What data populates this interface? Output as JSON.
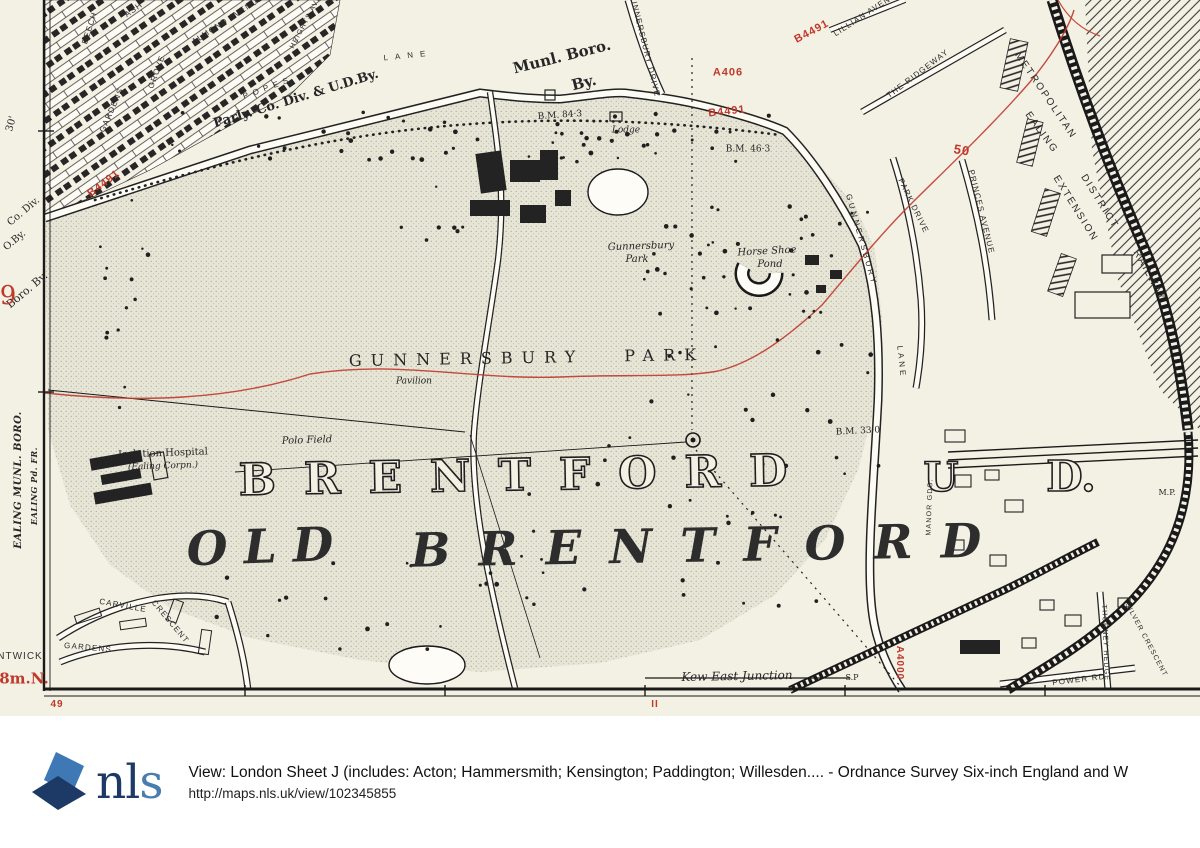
{
  "map": {
    "colors": {
      "paper": "#f3f0e4",
      "ink": "#262626",
      "red": "#c0392b",
      "road_fill": "#fcfbf4",
      "stipple_base": "#e7e5d6"
    },
    "labels": [
      {
        "n": "street-almond-avenue",
        "t": "ALMOND AVENUE",
        "x": 228,
        "y": 20,
        "s": 8,
        "r": -33,
        "c": "street"
      },
      {
        "n": "street-beech",
        "t": "BEECH",
        "x": 90,
        "y": 28,
        "s": 8,
        "r": -72,
        "c": "street"
      },
      {
        "n": "street-ash",
        "t": "ASH",
        "x": 134,
        "y": 10,
        "s": 8,
        "r": -35,
        "c": "street"
      },
      {
        "n": "street-gardens-nw",
        "t": "GARDENS",
        "x": 112,
        "y": 110,
        "s": 8,
        "r": -66,
        "c": "street"
      },
      {
        "n": "street-grove",
        "t": "GROVE",
        "x": 157,
        "y": 72,
        "s": 8,
        "r": -70,
        "c": "street"
      },
      {
        "n": "street-heights-ave",
        "t": "HEIGHTS AVE",
        "x": 306,
        "y": 22,
        "s": 7,
        "r": -62,
        "c": "street"
      },
      {
        "n": "street-popes",
        "t": "POPES",
        "x": 268,
        "y": 88,
        "s": 8,
        "r": -20,
        "c": "street",
        "ls": 5
      },
      {
        "n": "street-popes-lane",
        "t": "LANE",
        "x": 408,
        "y": 56,
        "s": 8,
        "r": -6,
        "c": "street",
        "ls": 7
      },
      {
        "n": "boundary-parly-co-div",
        "t": "Parly. Co. Div. & U.D.By.",
        "x": 296,
        "y": 99,
        "s": 13,
        "r": -17,
        "c": "serifb"
      },
      {
        "n": "boundary-munl-boro",
        "t": "Munl. Boro.",
        "x": 562,
        "y": 57,
        "s": 15,
        "r": -14,
        "c": "serifb"
      },
      {
        "n": "boundary-munl-boro-by",
        "t": "By.",
        "x": 584,
        "y": 83,
        "s": 15,
        "r": -14,
        "c": "serifb"
      },
      {
        "n": "road-number-b4491-west",
        "t": "B4491",
        "x": 104,
        "y": 184,
        "s": 11,
        "r": -37,
        "c": "red"
      },
      {
        "n": "road-number-a406",
        "t": "A406",
        "x": 728,
        "y": 73,
        "s": 11,
        "r": 0,
        "c": "red"
      },
      {
        "n": "road-number-b4491-north",
        "t": "B4491",
        "x": 727,
        "y": 112,
        "s": 11,
        "r": -6,
        "c": "red"
      },
      {
        "n": "road-number-b4491-ne",
        "t": "B4491",
        "x": 812,
        "y": 32,
        "s": 11,
        "r": -28,
        "c": "red"
      },
      {
        "n": "street-gunnersbury-drive",
        "t": "GUNNERSBURY DRIVE",
        "x": 644,
        "y": 44,
        "s": 8,
        "r": 76,
        "c": "street"
      },
      {
        "n": "street-lillian-avenue",
        "t": "LILLIAN AVENUE",
        "x": 868,
        "y": 13,
        "s": 8,
        "r": -33,
        "c": "street"
      },
      {
        "n": "street-the-ridgeway",
        "t": "THE RIDGEWAY",
        "x": 918,
        "y": 74,
        "s": 8,
        "r": -37,
        "c": "street"
      },
      {
        "n": "street-park-drive",
        "t": "PARK DRIVE",
        "x": 913,
        "y": 206,
        "s": 8,
        "r": 64,
        "c": "street"
      },
      {
        "n": "street-princes-avenue",
        "t": "PRINCES AVENUE",
        "x": 981,
        "y": 212,
        "s": 8,
        "r": 76,
        "c": "street"
      },
      {
        "n": "contour-number-50",
        "t": "50",
        "x": 962,
        "y": 150,
        "s": 13,
        "r": 10,
        "c": "red"
      },
      {
        "n": "street-gunnersbury-lane",
        "t": "GUNNERSBURY",
        "x": 861,
        "y": 240,
        "s": 8,
        "r": 74,
        "c": "street",
        "ls": 3
      },
      {
        "n": "street-gunnersbury-lane-2",
        "t": "LANE",
        "x": 901,
        "y": 362,
        "s": 8,
        "r": 84,
        "c": "street",
        "ls": 3
      },
      {
        "n": "railway-metropolitan",
        "t": "METROPOLITAN",
        "x": 1045,
        "y": 96,
        "s": 10,
        "r": 56,
        "c": "street",
        "ls": 2
      },
      {
        "n": "railway-district",
        "t": "DISTRICT",
        "x": 1099,
        "y": 202,
        "s": 10,
        "r": 58,
        "c": "street",
        "ls": 2
      },
      {
        "n": "railway-railway",
        "t": "RAILWAY",
        "x": 1149,
        "y": 276,
        "s": 10,
        "r": 61,
        "c": "street",
        "ls": 2
      },
      {
        "n": "railway-ealing",
        "t": "EALING",
        "x": 1041,
        "y": 133,
        "s": 10,
        "r": 54,
        "c": "street",
        "ls": 2
      },
      {
        "n": "railway-extension",
        "t": "EXTENSION",
        "x": 1075,
        "y": 209,
        "s": 10,
        "r": 58,
        "c": "street",
        "ls": 2
      },
      {
        "n": "benchmark-84-3",
        "t": "B.M. 84·3",
        "x": 560,
        "y": 116,
        "s": 9,
        "r": -4,
        "c": "serif"
      },
      {
        "n": "label-lodge",
        "t": "Lodge",
        "x": 626,
        "y": 131,
        "s": 9,
        "r": 0,
        "c": "it"
      },
      {
        "n": "benchmark-46-3",
        "t": "B.M. 46·3",
        "x": 748,
        "y": 150,
        "s": 9,
        "r": 0,
        "c": "serif"
      },
      {
        "n": "label-gunnersbury-park-small",
        "t": "Gunnersbury",
        "x": 641,
        "y": 247,
        "s": 10,
        "r": -2,
        "c": "it"
      },
      {
        "n": "label-gunnersbury-park-small-2",
        "t": "Park",
        "x": 637,
        "y": 260,
        "s": 10,
        "r": 0,
        "c": "it"
      },
      {
        "n": "label-horse-shoe-pond",
        "t": "Horse Shoe",
        "x": 767,
        "y": 252,
        "s": 10,
        "r": -3,
        "c": "it"
      },
      {
        "n": "label-horse-shoe-pond-2",
        "t": "Pond",
        "x": 770,
        "y": 265,
        "s": 10,
        "r": 0,
        "c": "it"
      },
      {
        "n": "label-gunnersbury-park",
        "t": "GUNNERSBURY PARK",
        "x": 527,
        "y": 358,
        "s": 16,
        "r": -1,
        "c": "serif",
        "ls": 9,
        "ws": 26
      },
      {
        "n": "label-pavilion",
        "t": "Pavilion",
        "x": 414,
        "y": 382,
        "s": 9,
        "r": 0,
        "c": "it"
      },
      {
        "n": "label-polo-field",
        "t": "Polo Field",
        "x": 307,
        "y": 441,
        "s": 10,
        "r": -2,
        "c": "it"
      },
      {
        "n": "benchmark-33-0",
        "t": "B.M. 33·0",
        "x": 858,
        "y": 432,
        "s": 9,
        "r": -3,
        "c": "serif"
      },
      {
        "n": "label-brentford",
        "t": "BRENTFORD",
        "x": 527,
        "y": 476,
        "s": 44,
        "r": -1,
        "c": "out",
        "ls": 28
      },
      {
        "n": "label-brentford-u",
        "t": "U",
        "x": 941,
        "y": 478,
        "s": 40,
        "r": 0,
        "c": "out"
      },
      {
        "n": "label-brentford-d",
        "t": "D.",
        "x": 1071,
        "y": 477,
        "s": 42,
        "r": 0,
        "c": "out"
      },
      {
        "n": "label-old",
        "t": "OLD",
        "x": 268,
        "y": 547,
        "s": 47,
        "r": -2,
        "c": "bigit",
        "ls": 16
      },
      {
        "n": "label-old-brentford",
        "t": "BRENTFORD",
        "x": 710,
        "y": 546,
        "s": 47,
        "r": -1,
        "c": "bigit",
        "ls": 28
      },
      {
        "n": "label-isolation-hospital",
        "t": "Isolation Hospital",
        "x": 163,
        "y": 454,
        "s": 10,
        "r": -2,
        "c": "serif"
      },
      {
        "n": "label-ealing-corpn",
        "t": "(Ealing Corpn.)",
        "x": 163,
        "y": 467,
        "s": 9,
        "r": -2,
        "c": "it"
      },
      {
        "n": "street-manor-gds",
        "t": "MANOR GDS.",
        "x": 930,
        "y": 507,
        "s": 7,
        "r": -88,
        "c": "street"
      },
      {
        "n": "label-mp",
        "t": "M.P.",
        "x": 1167,
        "y": 493,
        "s": 8,
        "r": 0,
        "c": "serif"
      },
      {
        "n": "label-kew-east-junction",
        "t": "Kew East Junction",
        "x": 737,
        "y": 676,
        "s": 12,
        "r": -1,
        "c": "it"
      },
      {
        "n": "label-sp",
        "t": "S.P",
        "x": 852,
        "y": 678,
        "s": 8,
        "r": 0,
        "c": "serif"
      },
      {
        "n": "road-number-a4000",
        "t": "A4000",
        "x": 899,
        "y": 663,
        "s": 10,
        "r": 90,
        "c": "red"
      },
      {
        "n": "street-power-rd",
        "t": "POWER RD",
        "x": 1079,
        "y": 680,
        "s": 8,
        "r": -7,
        "c": "street"
      },
      {
        "n": "street-thorney-hedge",
        "t": "THORNEY HEDGE",
        "x": 1105,
        "y": 643,
        "s": 7,
        "r": 88,
        "c": "street"
      },
      {
        "n": "street-silver-crescent",
        "t": "SILVER CRESCENT",
        "x": 1146,
        "y": 640,
        "s": 7,
        "r": 62,
        "c": "street"
      },
      {
        "n": "street-carville",
        "t": "CARVILLE",
        "x": 123,
        "y": 606,
        "s": 8,
        "r": 10,
        "c": "street"
      },
      {
        "n": "street-carville-crescent",
        "t": "CRESCENT",
        "x": 170,
        "y": 622,
        "s": 8,
        "r": 50,
        "c": "street"
      },
      {
        "n": "street-gardens-sw",
        "t": "GARDENS",
        "x": 88,
        "y": 648,
        "s": 8,
        "r": 5,
        "c": "street"
      },
      {
        "n": "margin-30min",
        "t": "30'",
        "x": 12,
        "y": 124,
        "s": 10,
        "r": -75,
        "c": "serif"
      },
      {
        "n": "margin-co-div",
        "t": "Co. Div.",
        "x": 24,
        "y": 212,
        "s": 10,
        "r": -40,
        "c": "serif"
      },
      {
        "n": "margin-o-by",
        "t": "O.By.",
        "x": 15,
        "y": 241,
        "s": 10,
        "r": -40,
        "c": "serif"
      },
      {
        "n": "margin-boro-by",
        "t": "Boro. By.",
        "x": 27,
        "y": 290,
        "s": 11,
        "r": -40,
        "c": "serif"
      },
      {
        "n": "margin-sheet-9",
        "t": "9",
        "x": 8,
        "y": 296,
        "s": 26,
        "r": 0,
        "c": "redserif"
      },
      {
        "n": "margin-ealing-munl-boro",
        "t": "EALING MUNL. BORO.",
        "x": 19,
        "y": 480,
        "s": 10,
        "r": -90,
        "c": "mbold"
      },
      {
        "n": "margin-ealing-pd",
        "t": "EALING Pd. FR.",
        "x": 34,
        "y": 486,
        "s": 8,
        "r": -90,
        "c": "mbold"
      },
      {
        "n": "margin-ntwick",
        "t": "NTWICK",
        "x": 20,
        "y": 657,
        "s": 10,
        "r": 0,
        "c": "sans"
      },
      {
        "n": "margin-8m-n",
        "t": "8m.N.",
        "x": 24,
        "y": 679,
        "s": 15,
        "r": 0,
        "c": "redserifb"
      },
      {
        "n": "margin-49",
        "t": "49",
        "x": 57,
        "y": 705,
        "s": 10,
        "r": 0,
        "c": "red"
      },
      {
        "n": "margin-tick-11",
        "t": "II",
        "x": 655,
        "y": 705,
        "s": 10,
        "r": 0,
        "c": "red"
      }
    ]
  },
  "footer": {
    "logo_text_dark": "nl",
    "logo_text_light": "s",
    "logo_color_dark": "#1d3a66",
    "logo_color_light": "#3f79b5",
    "title": "View: London Sheet J (includes: Acton; Hammersmith; Kensington; Paddington; Willesden.... - Ordnance Survey Six-inch England and W",
    "url": "http://maps.nls.uk/view/102345855"
  }
}
